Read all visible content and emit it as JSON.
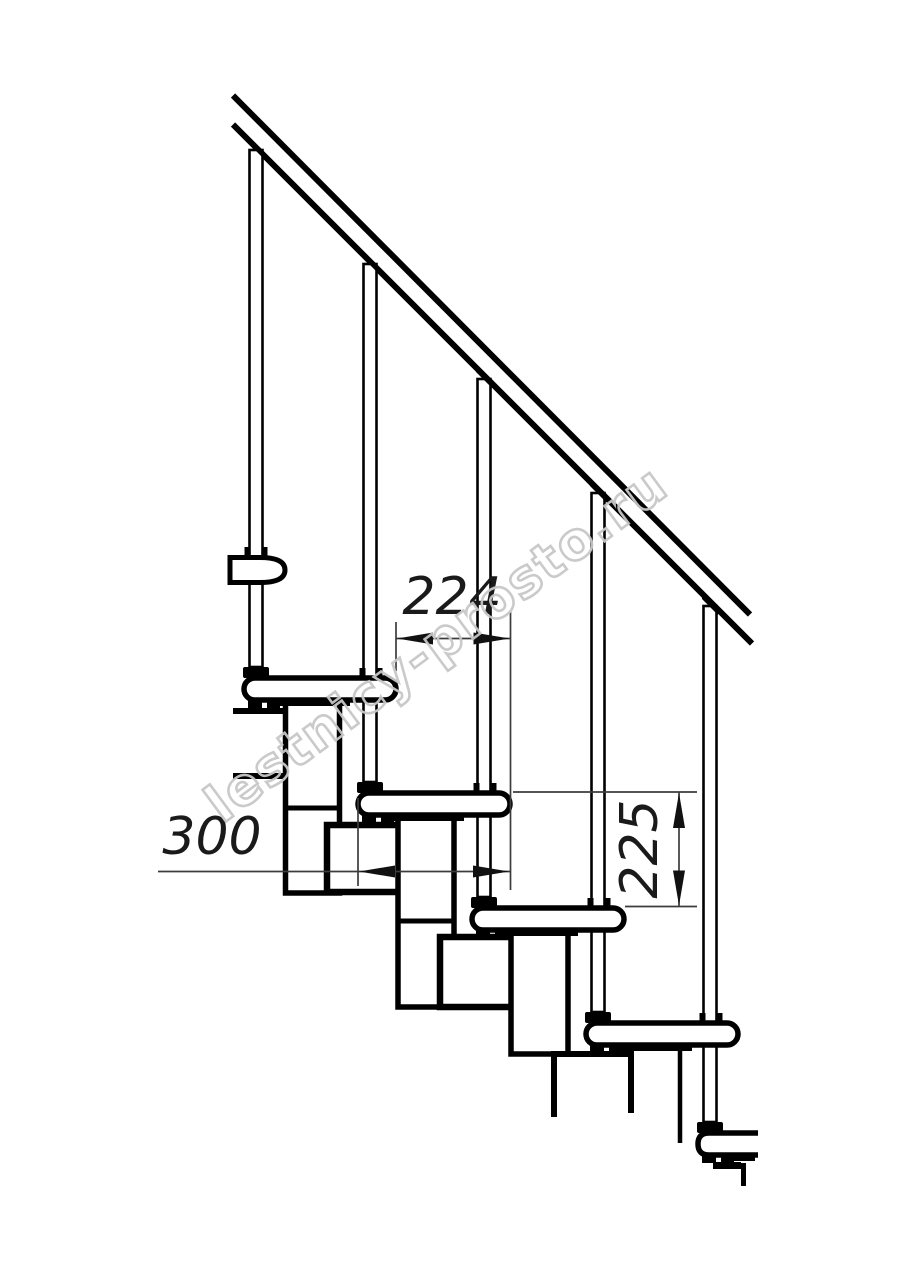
{
  "page": {
    "background": "#ffffff"
  },
  "drawing": {
    "watermark_text": "lestnicy-prosto.ru",
    "dimensions": [
      {
        "id": "step-going",
        "value": "224",
        "orientation": "horizontal"
      },
      {
        "id": "tread-depth",
        "value": "300",
        "orientation": "horizontal"
      },
      {
        "id": "riser-height",
        "value": "225",
        "orientation": "vertical"
      }
    ],
    "colors": {
      "line": "#000000",
      "dimension_line": "#3c3c3c",
      "dimension_text": "#1a1a1a",
      "watermark_outline": "#c7c7c7"
    }
  }
}
